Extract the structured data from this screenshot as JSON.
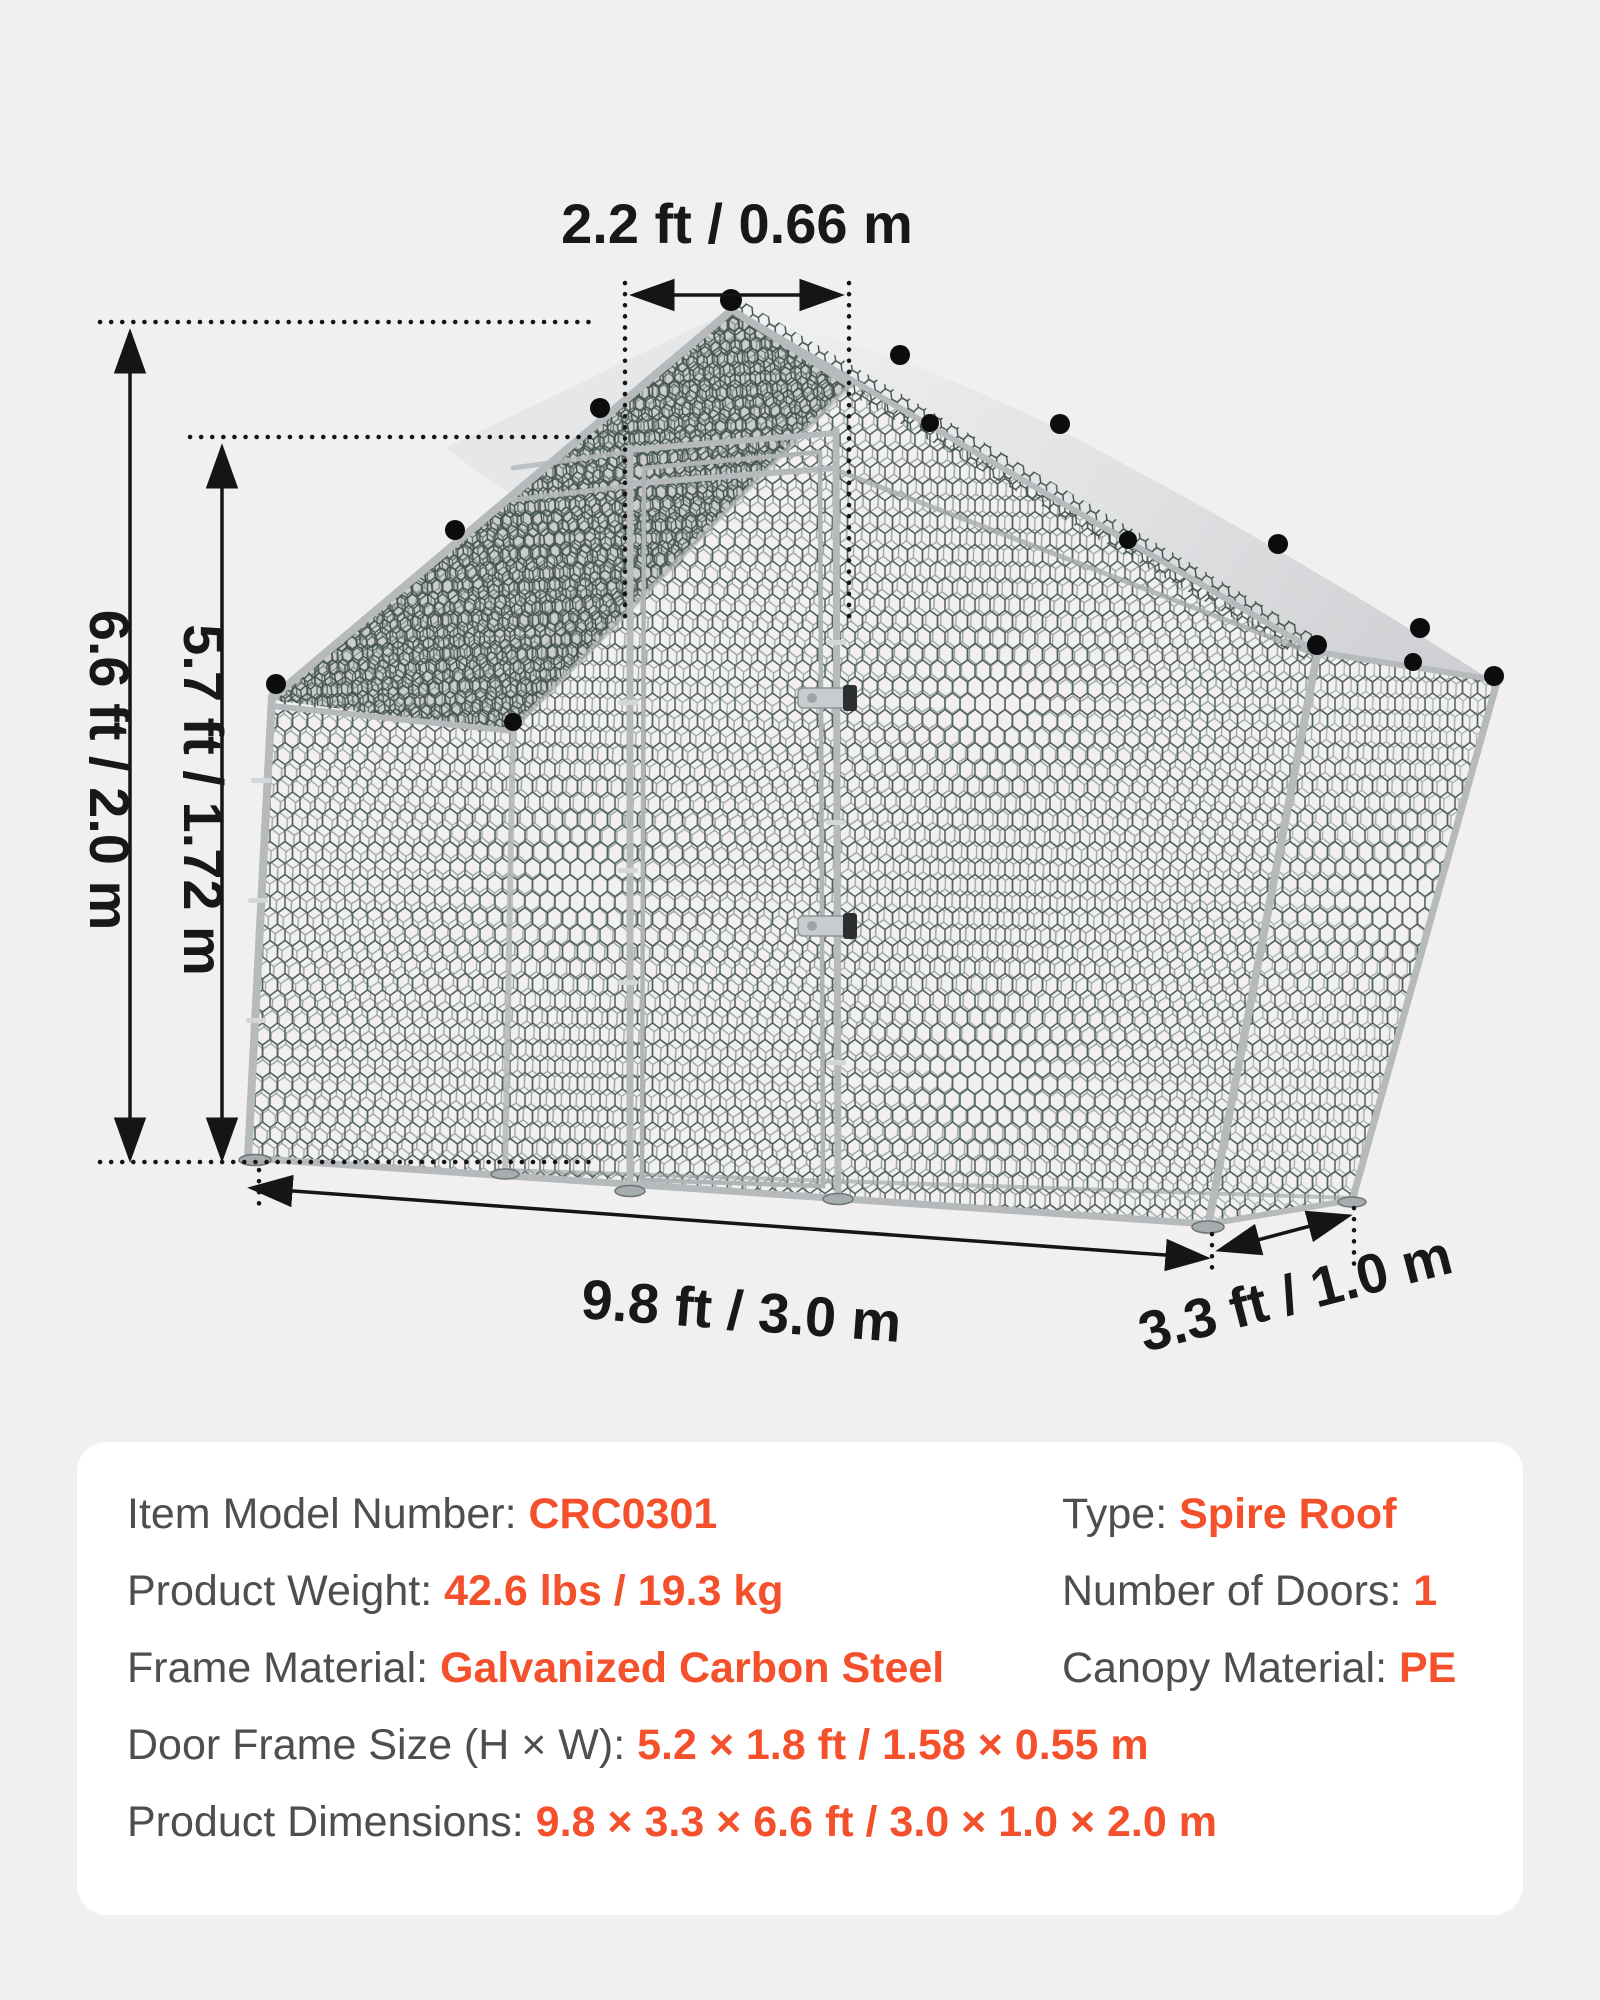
{
  "diagram": {
    "ridge_width": "2.2 ft / 0.66 m",
    "total_height": "6.6 ft / 2.0 m",
    "wall_height": "5.7 ft / 1.72 m",
    "length": "9.8 ft / 3.0 m",
    "depth": "3.3 ft / 1.0 m"
  },
  "specs": {
    "left": [
      {
        "label": "Item Model Number: ",
        "value": "CRC0301"
      },
      {
        "label": "Product Weight: ",
        "value": "42.6 lbs / 19.3 kg"
      },
      {
        "label": "Frame Material: ",
        "value": "Galvanized Carbon Steel"
      },
      {
        "label": "Door Frame Size (H × W): ",
        "value": "5.2 × 1.8 ft / 1.58 × 0.55 m"
      },
      {
        "label": "Product Dimensions: ",
        "value": "9.8 × 3.3 × 6.6 ft / 3.0 × 1.0 × 2.0 m"
      }
    ],
    "right": [
      {
        "label": "Type: ",
        "value": "Spire Roof"
      },
      {
        "label": "Number of Doors: ",
        "value": "1"
      },
      {
        "label": "Canopy Material: ",
        "value": "PE"
      }
    ]
  },
  "colors": {
    "background": "#F1F0EE",
    "panel": "#FFFFFF",
    "accent_orange": "#F3502B",
    "label_gray": "#4E4E50",
    "dimension_text": "#18181A",
    "mesh_wire": "#50605A",
    "canopy_gray": "#DDDEE0",
    "frame_silver": "#B6BABD"
  }
}
